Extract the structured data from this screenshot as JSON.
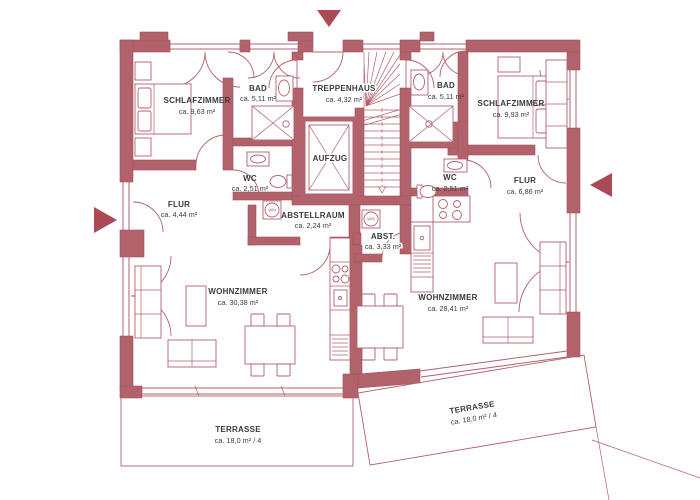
{
  "plan": {
    "type": "floor-plan",
    "colors": {
      "wall": "#b2626b",
      "line": "#b2626b",
      "text": "#3a3a3a",
      "arrow": "#ab4a55",
      "background": "#ffffff"
    },
    "rooms": {
      "schlafzimmer_left": {
        "label": "SCHLAFZIMMER",
        "area": "ca.  9,63 m²"
      },
      "bad_left": {
        "label": "BAD",
        "area": "ca.  5,11 m²"
      },
      "treppenhaus": {
        "label": "TREPPENHAUS",
        "area": "ca.  4,32 m²"
      },
      "bad_right": {
        "label": "BAD",
        "area": "ca.  5,11 m²"
      },
      "schlafzimmer_right": {
        "label": "SCHLAFZIMMER",
        "area": "ca.  9,93 m²"
      },
      "wc_left": {
        "label": "WC",
        "area": "ca.  2,51 m²"
      },
      "aufzug": {
        "label": "AUFZUG"
      },
      "wc_right": {
        "label": "WC",
        "area": "ca.  2,51 m²"
      },
      "flur_left": {
        "label": "FLUR",
        "area": "ca.  4,44 m²"
      },
      "flur_right": {
        "label": "FLUR",
        "area": "ca.  6,86 m²"
      },
      "abstellraum": {
        "label": "ABSTELLRAUM",
        "area": "ca.  2,24 m²"
      },
      "abst": {
        "label": "ABST.",
        "area": "ca.  3,33 m²"
      },
      "wohnzimmer_left": {
        "label": "WOHNZIMMER",
        "area": "ca.  30,38 m²"
      },
      "wohnzimmer_right": {
        "label": "WOHNZIMMER",
        "area": "ca.  28,41 m²"
      },
      "terrasse_left": {
        "label": "TERRASSE",
        "area": "ca.  18,0 m² / 4"
      },
      "terrasse_right": {
        "label": "TERRASSE",
        "area": "ca.  18,0 m² / 4"
      }
    },
    "appliances": {
      "washing_machine": "WM"
    }
  }
}
